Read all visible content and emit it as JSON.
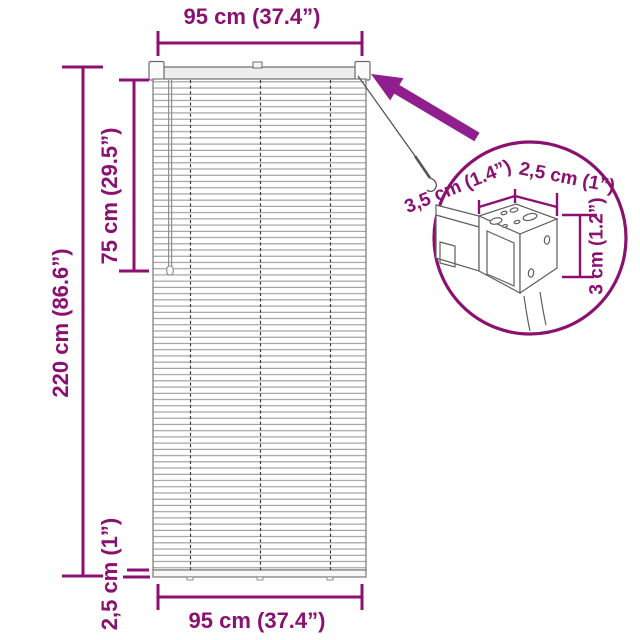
{
  "page": {
    "type": "product-dimension-diagram"
  },
  "colors": {
    "accent": "#8B1170",
    "arrow": "#8F1F8F",
    "drawing_outline": "#6a6a6a",
    "background": "#ffffff"
  },
  "icons": {
    "detail_arrow": "callout-arrow",
    "detail_circle": "magnifier-detail-circle"
  },
  "labels": {
    "top_width": "95 cm (37.4”)",
    "bottom_width": "95 cm (37.4”)",
    "total_height": "220 cm (86.6”)",
    "cord_length": "75 cm (29.5”)",
    "bottom_rail_height": "2,5 cm (1”)",
    "detail_depth": "3,5 cm (1.4”)",
    "detail_top_width": "2,5 cm (1”)",
    "detail_height": "3 cm (1.2”)"
  }
}
